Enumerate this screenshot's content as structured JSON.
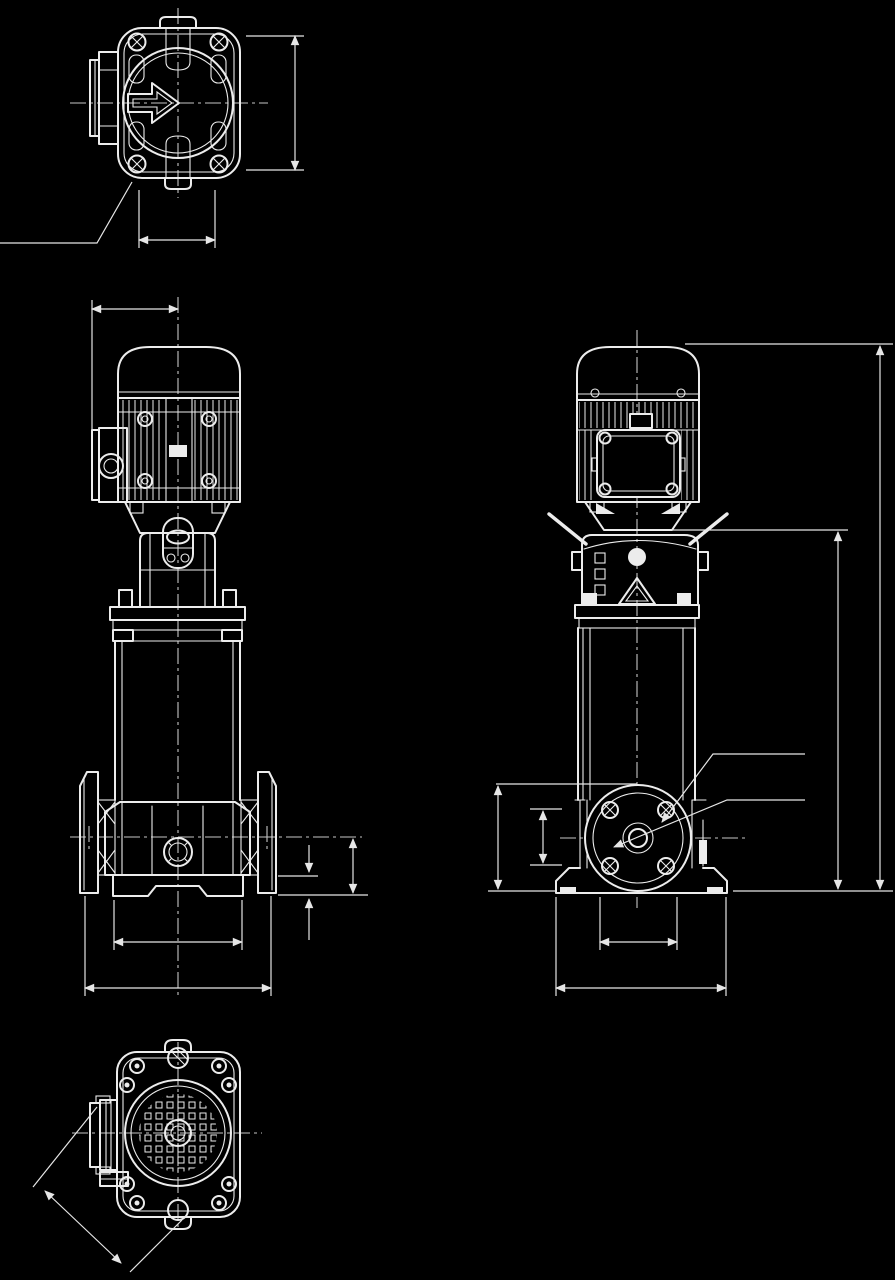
{
  "page": {
    "background": "#000000",
    "stroke_color": "#ececec",
    "centerline_color": "#c6c6c6",
    "kind": "technical dimensional outline drawing",
    "subject": "vertical multistage centrifugal pump with electric motor",
    "text_labels": []
  },
  "views": [
    {
      "id": "top-view",
      "name": "Motor top view",
      "position": "upper-left",
      "features": [
        "rounded-square fan cover",
        "flow-direction arrow",
        "terminal-box stub",
        "four corner bolt bosses",
        "lifting lug",
        "centerlines"
      ],
      "dimensions": [
        {
          "orientation": "vertical",
          "side": "right",
          "measures": "cover depth"
        },
        {
          "orientation": "horizontal",
          "side": "bottom",
          "measures": "boss spacing"
        }
      ],
      "leaders": [
        {
          "from": "lower-left bolt boss",
          "to": "off-canvas lower-left"
        }
      ]
    },
    {
      "id": "front-elevation",
      "name": "Front elevation",
      "position": "middle-left",
      "features": [
        "dome cap motor with cooling fins",
        "terminal box with conduit boss",
        "coupling lantern with inspection windows",
        "stage column",
        "inline suction and discharge flanges",
        "base feet"
      ],
      "dimensions": [
        {
          "orientation": "horizontal",
          "side": "top",
          "measures": "terminal-box face to pump centerline"
        },
        {
          "orientation": "vertical",
          "side": "right",
          "measures": "port centerline height above floor"
        },
        {
          "orientation": "vertical",
          "side": "right",
          "measures": "foot height"
        },
        {
          "orientation": "horizontal",
          "side": "bottom",
          "measures": "foot span"
        },
        {
          "orientation": "horizontal",
          "side": "bottom",
          "measures": "flange-to-flange overall width"
        }
      ]
    },
    {
      "id": "side-elevation",
      "name": "Side elevation",
      "position": "middle-right",
      "features": [
        "motor terminal-box face with corner bolts",
        "coupling guard rods",
        "pump head with warning triangle",
        "stage column",
        "port flange face with bolt holes",
        "base feet"
      ],
      "dimensions": [
        {
          "orientation": "vertical",
          "side": "right",
          "measures": "overall height"
        },
        {
          "orientation": "vertical",
          "side": "right",
          "measures": "height to pump head"
        },
        {
          "orientation": "vertical",
          "side": "left",
          "measures": "flange height above floor"
        },
        {
          "orientation": "vertical",
          "side": "left",
          "measures": "port bore"
        },
        {
          "orientation": "horizontal",
          "side": "bottom",
          "measures": "inner bolt span"
        },
        {
          "orientation": "horizontal",
          "side": "bottom",
          "measures": "foot span"
        }
      ],
      "leaders": [
        {
          "from": "right margin",
          "to": "flange raised face"
        },
        {
          "from": "right margin",
          "to": "flange bolt hole"
        }
      ]
    },
    {
      "id": "bottom-view",
      "name": "Base bottom view",
      "position": "lower-left",
      "features": [
        "rounded-corner base plate",
        "anchor bolt holes",
        "perforated strainer circle",
        "side port stub"
      ],
      "dimensions": [
        {
          "orientation": "diagonal",
          "side": "lower-left",
          "measures": "diagonal clearance from port face"
        }
      ]
    }
  ]
}
